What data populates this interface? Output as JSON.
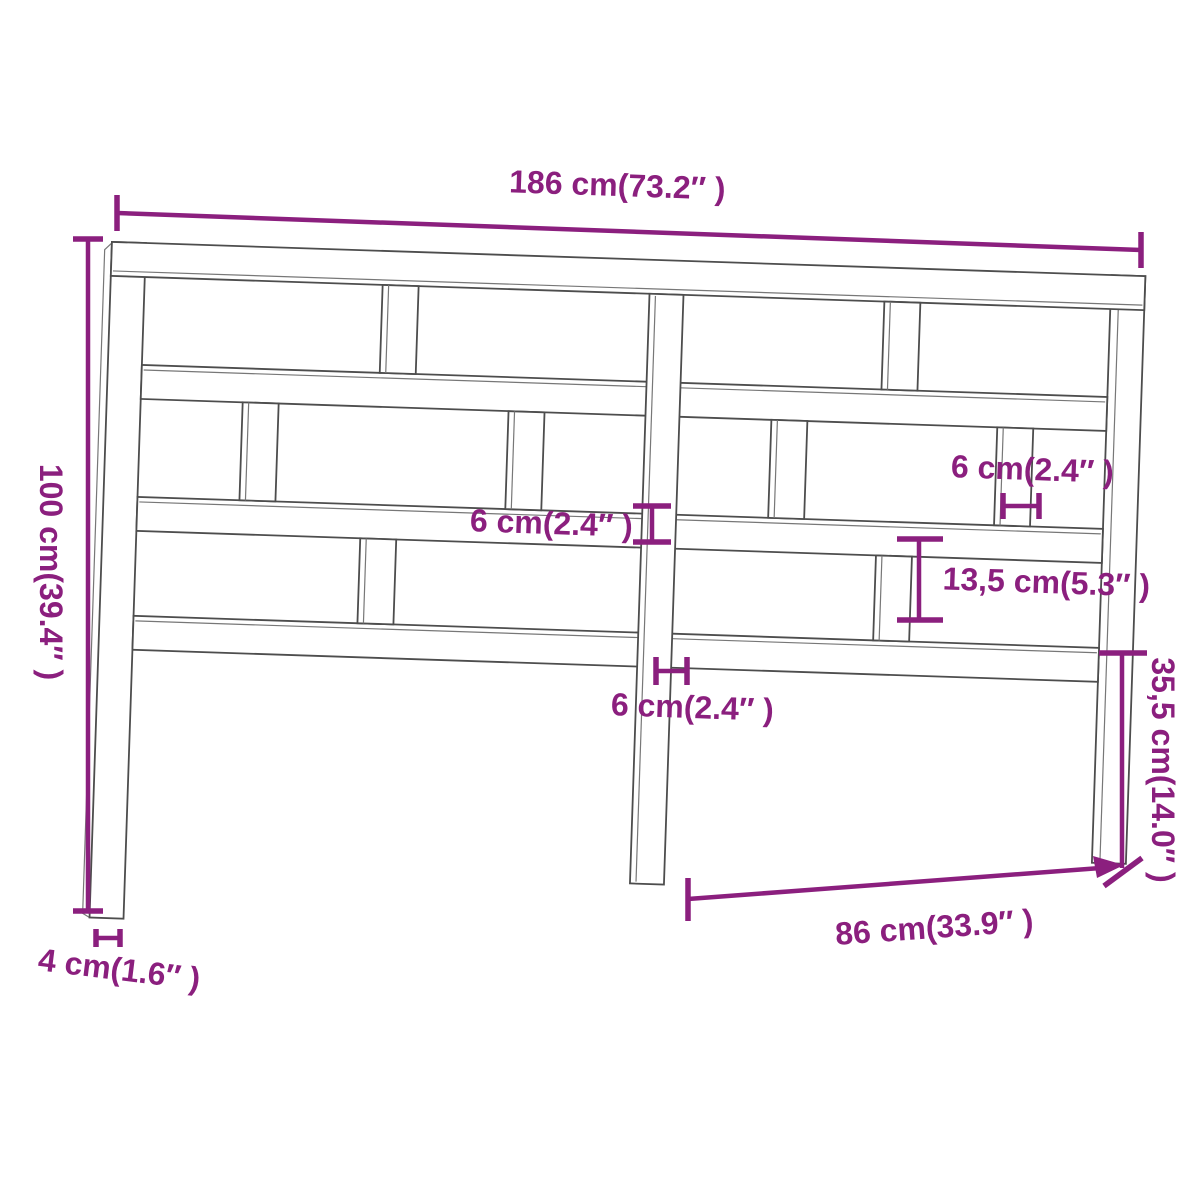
{
  "diagram": {
    "title": "headboard-dimension-drawing",
    "colors": {
      "dimension_accent": "#8B1F7E",
      "outline": "#4d4d4d",
      "background": "#ffffff"
    },
    "labels": {
      "total_width": "186 cm(73.2″ )",
      "total_height": "100 cm(39.4″ )",
      "leg_depth": "4 cm(1.6″ )",
      "rail_thickness": "6 cm(2.4″ )",
      "slat_width": "6 cm(2.4″ )",
      "center_post_width": "6 cm(2.4″ )",
      "slat_gap_height": "13,5 cm(5.3″ )",
      "leg_bottom_height": "35,5 cm(14.0″ )",
      "half_width": "86 cm(33.9″ )"
    }
  }
}
